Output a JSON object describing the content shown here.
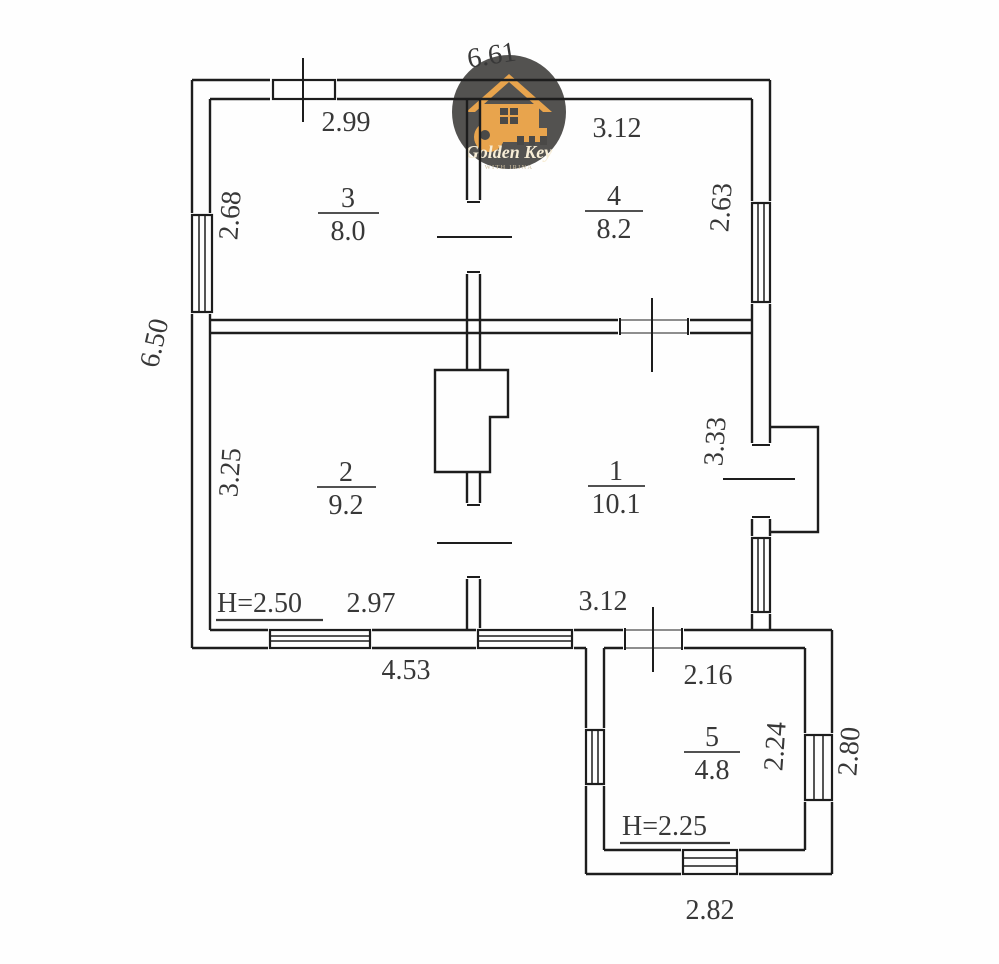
{
  "document": {
    "type": "floor-plan-scan",
    "line_color": "#1d1d1d",
    "text_color": "#383838",
    "background": "#fefefe"
  },
  "dimensions": {
    "top_width": "6.61",
    "top_left_section": "2.99",
    "top_right_section": "3.12",
    "room3_side": "2.68",
    "room4_side": "2.63",
    "left_height": "6.50",
    "room2_side": "3.25",
    "room1_side": "3.33",
    "ceiling_main": "H=2.50",
    "room2_bottom": "2.97",
    "room1_bottom": "3.12",
    "bottom_width": "4.53",
    "annex_top": "2.16",
    "annex_side_inner": "2.24",
    "annex_side_outer": "2.80",
    "ceiling_annex": "H=2.25",
    "annex_bottom": "2.82"
  },
  "rooms": [
    {
      "number": "3",
      "area": "8.0"
    },
    {
      "number": "4",
      "area": "8.2"
    },
    {
      "number": "2",
      "area": "9.2"
    },
    {
      "number": "1",
      "area": "10.1"
    },
    {
      "number": "5",
      "area": "4.8"
    }
  ],
  "logo": {
    "title": "Golden Key",
    "subtitle": "WITH IRINA",
    "circle_color": "#4a4947",
    "gold_color": "#e8a44d"
  }
}
